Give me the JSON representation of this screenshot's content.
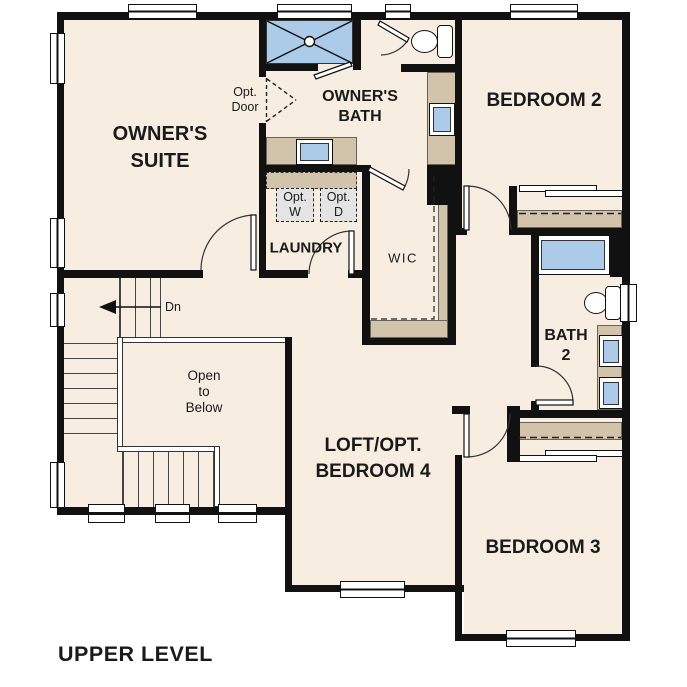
{
  "plan_title": "UPPER LEVEL",
  "colors": {
    "wall": "#111111",
    "floor": "#f7eee1",
    "counter": "#d2c3ab",
    "fixture": "#accbe9",
    "optbox": "#e4e4e4"
  },
  "rooms": {
    "owners_suite": {
      "line1": "OWNER'S",
      "line2": "SUITE"
    },
    "owners_bath": {
      "line1": "OWNER'S",
      "line2": "BATH"
    },
    "bedroom2": {
      "label": "BEDROOM 2"
    },
    "laundry": {
      "label": "LAUNDRY"
    },
    "wic": {
      "label": "WIC"
    },
    "bath2": {
      "line1": "BATH",
      "line2": "2"
    },
    "loft": {
      "line1": "LOFT/OPT.",
      "line2": "BEDROOM 4"
    },
    "bedroom3": {
      "label": "BEDROOM 3"
    },
    "open_to_below": {
      "line1": "Open",
      "line2": "to",
      "line3": "Below"
    }
  },
  "annotations": {
    "stairs_direction": "Dn",
    "opt_door": {
      "line1": "Opt.",
      "line2": "Door"
    },
    "opt_washer": {
      "line1": "Opt.",
      "line2": "W"
    },
    "opt_dryer": {
      "line1": "Opt.",
      "line2": "D"
    }
  },
  "icons": {
    "shower": "shower-pan-icon",
    "bathtub": "bathtub-icon",
    "toilet": "toilet-icon",
    "sink": "sink-icon",
    "stairs": "staircase-icon",
    "down_arrow": "down-arrow-icon",
    "window": "window-icon",
    "door": "door-swing-icon"
  }
}
